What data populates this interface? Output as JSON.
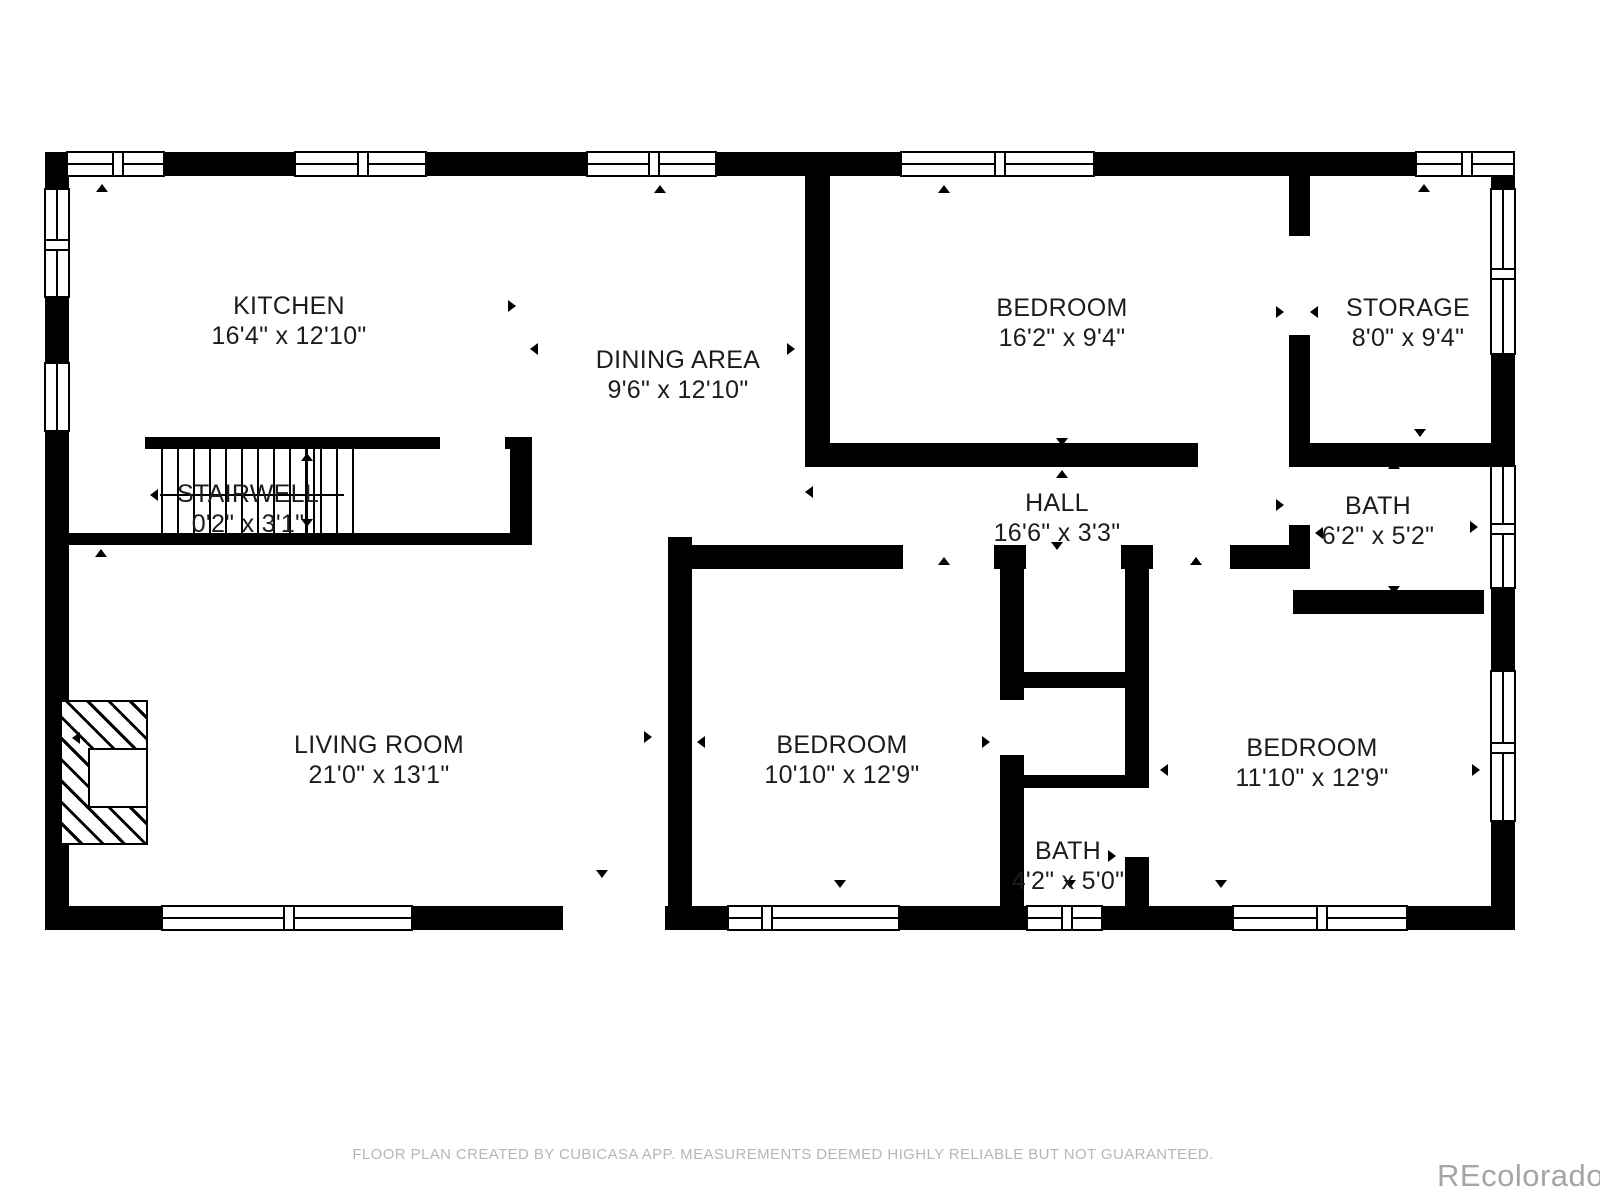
{
  "floor_plan": {
    "rooms": {
      "kitchen": {
        "name": "KITCHEN",
        "dimensions": "16'4\" x 12'10\""
      },
      "dining_area": {
        "name": "DINING AREA",
        "dimensions": "9'6\" x 12'10\""
      },
      "bedroom_top": {
        "name": "BEDROOM",
        "dimensions": "16'2\" x 9'4\""
      },
      "storage": {
        "name": "STORAGE",
        "dimensions": "8'0\" x 9'4\""
      },
      "stairwell": {
        "name": "STAIRWELL",
        "dimensions": "0'2\" x 3'1\""
      },
      "hall": {
        "name": "HALL",
        "dimensions": "16'6\" x 3'3\""
      },
      "bath_upper": {
        "name": "BATH",
        "dimensions": "6'2\" x 5'2\""
      },
      "living_room": {
        "name": "LIVING ROOM",
        "dimensions": "21'0\" x 13'1\""
      },
      "bedroom_middle": {
        "name": "BEDROOM",
        "dimensions": "10'10\" x 12'9\""
      },
      "bedroom_right": {
        "name": "BEDROOM",
        "dimensions": "11'10\" x 12'9\""
      },
      "bath_lower": {
        "name": "BATH",
        "dimensions": "4'2\" x 5'0\""
      }
    },
    "footer": "FLOOR PLAN CREATED BY CUBICASA APP. MEASUREMENTS DEEMED HIGHLY RELIABLE BUT NOT GUARANTEED.",
    "watermark": "REcolorado",
    "icons": {
      "measure-arrow": "small black triangle marking measured wall extents",
      "stair-direction-arrow": "long left-pointing arrow across stair treads"
    },
    "colors": {
      "wall": "#000000",
      "background": "#ffffff",
      "label_text": "#1c1c1c",
      "footer_text": "#b6b6b6",
      "watermark_text": "#a5a5a5"
    }
  }
}
